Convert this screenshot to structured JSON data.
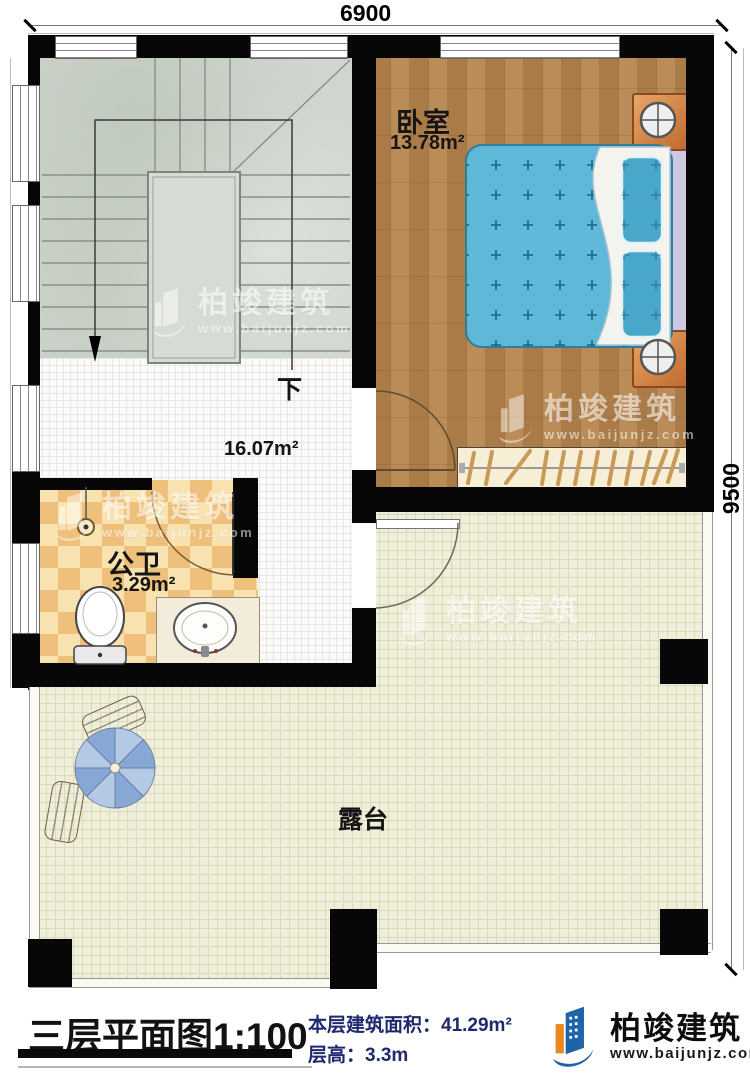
{
  "dimensions": {
    "width_mm": "6900",
    "height_mm": "9500"
  },
  "rooms": {
    "bedroom": {
      "name": "卧室",
      "area": "13.78m²"
    },
    "bathroom": {
      "name": "公卫",
      "area": "3.29m²"
    },
    "hall": {
      "area": "16.07m²"
    },
    "terrace": {
      "name": "露台"
    },
    "stair": {
      "direction_label": "下"
    }
  },
  "footer": {
    "title": "三层平面图",
    "scale": "1:100",
    "area_label": "本层建筑面积：",
    "area_value": "41.29m²",
    "floor_height_label": "层高：",
    "floor_height_value": "3.3m"
  },
  "brand": {
    "name": "柏竣建筑",
    "website": "www.baijunjz.com"
  },
  "colors": {
    "wall": "#070707",
    "wood_floor": "#b5834b",
    "bed_blue": "#60b8d8",
    "terrace_tile": "#efeeda",
    "bath_tile": "#eec07c",
    "stats_navy": "#1f2a6e",
    "brand_blue": "#1f63a8",
    "brand_orange": "#e8881f"
  }
}
